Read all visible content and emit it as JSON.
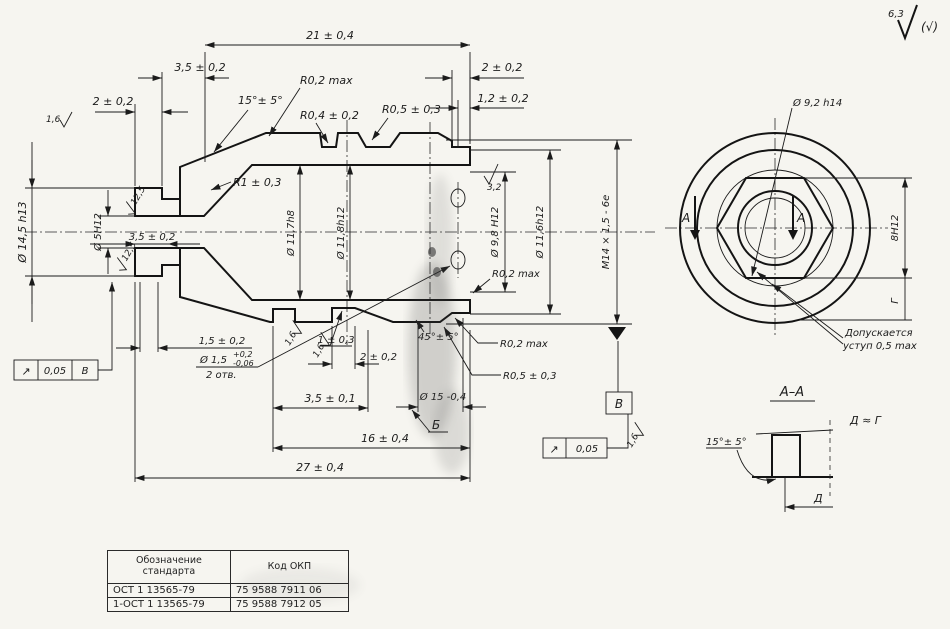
{
  "finish_corner": {
    "value": "6,3",
    "paren": "(√)"
  },
  "main": {
    "dim_21": "21 ± 0,4",
    "dim_35_top": "3,5 ± 0,2",
    "dim_2_left": "2 ± 0,2",
    "angle_15": "15°± 5°",
    "r02_top": "R0,2 max",
    "r04": "R0,4 ± 0,2",
    "r05_top": "R0,5 ± 0,3",
    "dim_2_right": "2 ± 0,2",
    "dim_12": "1,2 ± 0,2",
    "dia_145": "Ø 14,5 h13",
    "dia_5": "Ø 5Н12",
    "dim_35_bore": "3,5 ± 0,2",
    "r1": "R1 ± 0,3",
    "dia_117": "Ø 11,7h8",
    "dia_118": "Ø 11,8h12",
    "dia_98": "Ø 9,8 Н12",
    "dia_116": "Ø 11,6h12",
    "thread": "М14 × 1,5 - 6е",
    "rough_32": "3,2",
    "r02_mid": "R0,2 max",
    "r02_low": "R0,2 max",
    "r05_low": "R0,5 ± 0,3",
    "dim_15_low": "1,5 ± 0,2",
    "hole_dia": "Ø 1,5",
    "hole_up": "+0,2",
    "hole_dn": "-0,06",
    "hole_count": "2 отв.",
    "groove_depth": "1 ± 0,3",
    "groove_width": "2 ± 0,2",
    "dim_35_bot": "3,5 ± 0,1",
    "dim_16": "16 ± 0,4",
    "dim_27": "27 ± 0,4",
    "angle_45": "45°± 5°",
    "dia_15": "Ø 15 -0,4",
    "datum_b": "Б",
    "datum_v": "В",
    "frame_left": {
      "sym": "↗",
      "val": "0,05",
      "ref": "В"
    },
    "frame_right": {
      "sym": "↗",
      "val": "0,05"
    },
    "rough_16": "1,6",
    "rough_125": "12,5"
  },
  "end_view": {
    "dia_92": "Ø 9,2 h14",
    "hex": "8Н12",
    "dim_g": "Г",
    "sect": "А",
    "note1": "Допускается",
    "note2": "уступ 0,5 max"
  },
  "section": {
    "title": "А–А",
    "angle": "15°± 5°",
    "note": "Д ≈ Г",
    "dim_d": "Д"
  },
  "table": {
    "h1a": "Обозначение",
    "h1b": "стандарта",
    "h2": "Код ОКП",
    "rows": [
      {
        "std": "ОСТ 1 13565-79",
        "okp": "75 9588 7911 06"
      },
      {
        "std": "1-ОСТ 1 13565-79",
        "okp": "75 9588 7912 05"
      }
    ]
  }
}
